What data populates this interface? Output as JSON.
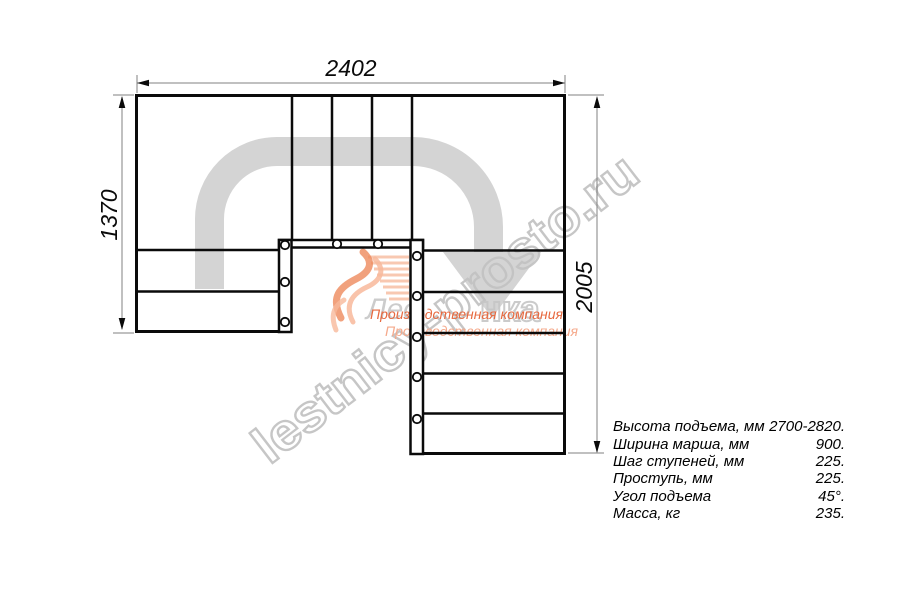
{
  "drawing": {
    "type": "staircase-plan-top-view",
    "dimensions": {
      "top_width_mm": "2402",
      "left_depth_mm": "1370",
      "right_depth_mm": "2005"
    }
  },
  "specs": {
    "rows": [
      {
        "label": "Высота подъема, мм",
        "value": "2700-2820."
      },
      {
        "label": "Ширина марша, мм",
        "value": "900."
      },
      {
        "label": "Шаг ступеней, мм",
        "value": "225."
      },
      {
        "label": "Проступь, мм",
        "value": "225."
      },
      {
        "label": "Угол подъема",
        "value": "45°."
      },
      {
        "label": "Масса, кг",
        "value": "235."
      }
    ]
  },
  "watermark": {
    "site_text": "lestnicy-prosto.ru",
    "logo_solid": "Лес",
    "logo_outline": "нка",
    "company_line": "Производственная компания"
  },
  "colors": {
    "line": "#0a0a0a",
    "walk_line_gray": "#d4d4d4",
    "dimension_gray": "#808080",
    "watermark_gray": "#c3c3c3",
    "logo_orange": "#ee8a5d",
    "logo_orange_light": "#f5a98b",
    "company_text_orange": "#e7693f"
  }
}
